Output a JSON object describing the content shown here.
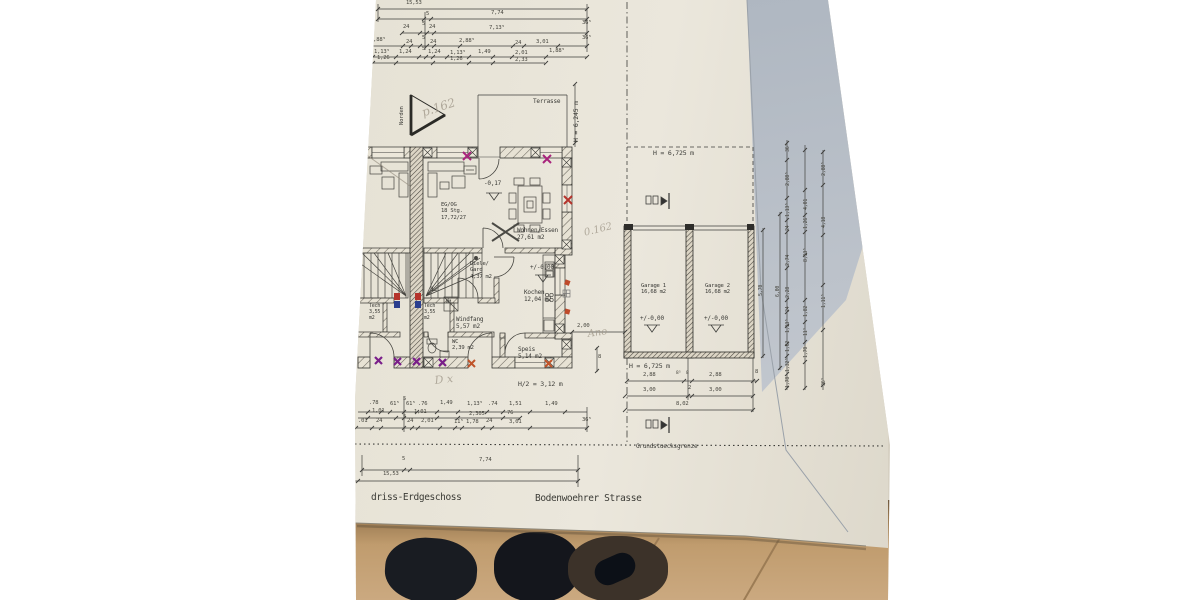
{
  "palette": {
    "paper": "#e8e4d8",
    "paper_shadow": "#b2bac4",
    "floor": "#c2a077",
    "ink": "#3f3f3c",
    "pencil": "#a29a8c",
    "marker_red": "#b5342c",
    "marker_blue": "#2b3f8f",
    "marker_magenta": "#a8247c",
    "marker_purple": "#7a1f8a",
    "marker_orange": "#c0542a"
  },
  "plan": {
    "title": "driss-Erdgeschoss",
    "street": "Bodenwoehrer Strasse",
    "boundary": "Grundstuecksgrenze",
    "north": "Norden",
    "terrace": "Terrasse",
    "heights": {
      "left": "H = 6,245 m",
      "garage_top": "H = 6,725 m",
      "garage_bottom": "H = 6,725 m",
      "half": "H/2 = 3,12 m"
    },
    "rooms": {
      "wohnen": "Wohnen/Essen\n27,61 m2",
      "stairs": "EG/OG\n18 Stg.\n17,72/27",
      "diele": "Diele/\nGard\n4,37 m2",
      "kochen": "Kochen\n12,04 m2",
      "windfang": "Windfang\n5,57 m2",
      "wc": "WC\n2,39 m2",
      "speis": "Speis\n5,14 m2",
      "tech_left": "Tech\n3,55\nm2",
      "tech_right": "Tech\n3,55\nm2",
      "wm": "WM",
      "garage1": "Garage 1\n16,68 m2",
      "garage2": "Garage 2\n16,68 m2"
    },
    "levels": {
      "wohnen": "-0,17",
      "kueche": "+/-0,00",
      "garage1": "+/-0,00",
      "garage2": "+/-0,00"
    }
  },
  "dims": {
    "labels": [
      {
        "t": "15,53",
        "x": 406,
        "y": 0
      },
      {
        "t": "5",
        "x": 426,
        "y": 11
      },
      {
        "t": "7,74",
        "x": 491,
        "y": 10
      },
      {
        "t": "24",
        "x": 403,
        "y": 24
      },
      {
        "t": "5",
        "x": 422,
        "y": 21
      },
      {
        "t": "24",
        "x": 429,
        "y": 24
      },
      {
        "t": "7,13⁵",
        "x": 489,
        "y": 25
      },
      {
        "t": "36⁵",
        "x": 582,
        "y": 20
      },
      {
        "t": "1,88⁵",
        "x": 370,
        "y": 37
      },
      {
        "t": "24",
        "x": 406,
        "y": 39
      },
      {
        "t": "5",
        "x": 422,
        "y": 35
      },
      {
        "t": "24",
        "x": 430,
        "y": 39
      },
      {
        "t": "2,88⁵",
        "x": 459,
        "y": 38
      },
      {
        "t": "24",
        "x": 515,
        "y": 40
      },
      {
        "t": "3,01",
        "x": 536,
        "y": 39
      },
      {
        "t": "36⁵",
        "x": 582,
        "y": 35
      },
      {
        "t": "1,13⁵",
        "x": 374,
        "y": 49
      },
      {
        "t": "1,24",
        "x": 399,
        "y": 49
      },
      {
        "t": "5",
        "x": 422,
        "y": 46
      },
      {
        "t": "1,24",
        "x": 428,
        "y": 49
      },
      {
        "t": "1,13⁵",
        "x": 450,
        "y": 50
      },
      {
        "t": "1,49",
        "x": 478,
        "y": 49
      },
      {
        "t": "2,01",
        "x": 515,
        "y": 50
      },
      {
        "t": "1,88⁵",
        "x": 549,
        "y": 48
      },
      {
        "t": "1,26",
        "x": 377,
        "y": 55
      },
      {
        "t": "1,26",
        "x": 450,
        "y": 56
      },
      {
        "t": "2,33",
        "x": 515,
        "y": 57
      },
      {
        "t": ".78",
        "x": 369,
        "y": 400
      },
      {
        "t": "61⁵",
        "x": 390,
        "y": 401
      },
      {
        "t": "5",
        "x": 403,
        "y": 396
      },
      {
        "t": "61⁵",
        "x": 406,
        "y": 401
      },
      {
        "t": ".76",
        "x": 418,
        "y": 401
      },
      {
        "t": "1,49",
        "x": 440,
        "y": 400
      },
      {
        "t": "1,13⁵",
        "x": 467,
        "y": 401
      },
      {
        "t": ".74",
        "x": 488,
        "y": 401
      },
      {
        "t": "1,51",
        "x": 509,
        "y": 401
      },
      {
        "t": "1,49",
        "x": 545,
        "y": 401
      },
      {
        "t": "1,01",
        "x": 372,
        "y": 408
      },
      {
        "t": "1,01",
        "x": 414,
        "y": 409
      },
      {
        "t": "2,305",
        "x": 469,
        "y": 411
      },
      {
        "t": "76",
        "x": 507,
        "y": 410
      },
      {
        "t": ".01",
        "x": 358,
        "y": 418
      },
      {
        "t": "24",
        "x": 376,
        "y": 418
      },
      {
        "t": "5",
        "x": 403,
        "y": 414
      },
      {
        "t": "24",
        "x": 407,
        "y": 418
      },
      {
        "t": "2,01",
        "x": 421,
        "y": 418
      },
      {
        "t": "11⁵",
        "x": 454,
        "y": 419
      },
      {
        "t": "1,78",
        "x": 466,
        "y": 419
      },
      {
        "t": "24",
        "x": 486,
        "y": 418
      },
      {
        "t": "3,01",
        "x": 509,
        "y": 419
      },
      {
        "t": "36⁵",
        "x": 582,
        "y": 417
      },
      {
        "t": "5",
        "x": 402,
        "y": 456
      },
      {
        "t": "7,74",
        "x": 479,
        "y": 457
      },
      {
        "t": "15,53",
        "x": 383,
        "y": 471
      },
      {
        "t": "2,00",
        "x": 577,
        "y": 323
      },
      {
        "t": "8",
        "x": 598,
        "y": 354
      },
      {
        "t": "2,88",
        "x": 643,
        "y": 372
      },
      {
        "t": "8⁵",
        "x": 676,
        "y": 371,
        "fs": 4.5
      },
      {
        "t": "8",
        "x": 686,
        "y": 371,
        "fs": 4.5
      },
      {
        "t": "2,88",
        "x": 709,
        "y": 372
      },
      {
        "t": "8",
        "x": 755,
        "y": 369
      },
      {
        "t": "3,00",
        "x": 643,
        "y": 387
      },
      {
        "t": "2",
        "x": 688,
        "y": 385
      },
      {
        "t": "3,00",
        "x": 709,
        "y": 387
      },
      {
        "t": "8,02",
        "x": 676,
        "y": 401
      },
      {
        "t": "5,70",
        "x": 758,
        "y": 296,
        "r": -90,
        "fs": 5
      },
      {
        "t": "6,00",
        "x": 775,
        "y": 297,
        "r": -90,
        "fs": 5
      },
      {
        "t": "36⁵",
        "x": 785,
        "y": 152,
        "r": -90,
        "fs": 5
      },
      {
        "t": "2,88⁵",
        "x": 785,
        "y": 186,
        "r": -90,
        "fs": 5
      },
      {
        "t": "1,13⁵",
        "x": 785,
        "y": 217,
        "r": -90,
        "fs": 5
      },
      {
        "t": "24",
        "x": 785,
        "y": 231,
        "r": -90,
        "fs": 5
      },
      {
        "t": "2,74",
        "x": 785,
        "y": 266,
        "r": -90,
        "fs": 5
      },
      {
        "t": "2,28",
        "x": 785,
        "y": 298,
        "r": -90,
        "fs": 5
      },
      {
        "t": "24",
        "x": 785,
        "y": 312,
        "r": -90,
        "fs": 5
      },
      {
        "t": "1,13⁵",
        "x": 785,
        "y": 333,
        "r": -90,
        "fs": 5
      },
      {
        "t": "1,62",
        "x": 785,
        "y": 352,
        "r": -90,
        "fs": 5
      },
      {
        "t": "1,32⁵",
        "x": 785,
        "y": 372,
        "r": -90,
        "fs": 5
      },
      {
        "t": "1,78",
        "x": 785,
        "y": 388,
        "r": -90,
        "fs": 5
      },
      {
        "t": "4,01",
        "x": 803,
        "y": 210,
        "r": -90,
        "fs": 5
      },
      {
        "t": "1,26",
        "x": 803,
        "y": 229,
        "r": -90,
        "fs": 5
      },
      {
        "t": "8,13⁵",
        "x": 803,
        "y": 262,
        "r": -90,
        "fs": 5
      },
      {
        "t": "1,82",
        "x": 803,
        "y": 317,
        "r": -90,
        "fs": 5
      },
      {
        "t": "11⁵",
        "x": 803,
        "y": 336,
        "r": -90,
        "fs": 5
      },
      {
        "t": "1,70",
        "x": 803,
        "y": 358,
        "r": -90,
        "fs": 5
      },
      {
        "t": "2,88⁵",
        "x": 821,
        "y": 176,
        "r": -90,
        "fs": 5
      },
      {
        "t": "4,18",
        "x": 821,
        "y": 228,
        "r": -90,
        "fs": 5
      },
      {
        "t": "1,11⁵",
        "x": 821,
        "y": 308,
        "r": -90,
        "fs": 5
      },
      {
        "t": "36⁵",
        "x": 821,
        "y": 386,
        "r": -90,
        "fs": 5
      }
    ]
  },
  "hand_notes": [
    {
      "t": "p.162",
      "x": 420,
      "y": 106,
      "r": -18,
      "fs": 12
    },
    {
      "t": "0.162",
      "x": 583,
      "y": 228,
      "r": -14,
      "fs": 10
    },
    {
      "t": "Ano",
      "x": 587,
      "y": 329,
      "r": -8,
      "fs": 10
    },
    {
      "t": "D x",
      "x": 434,
      "y": 374,
      "r": -6,
      "fs": 11
    }
  ]
}
